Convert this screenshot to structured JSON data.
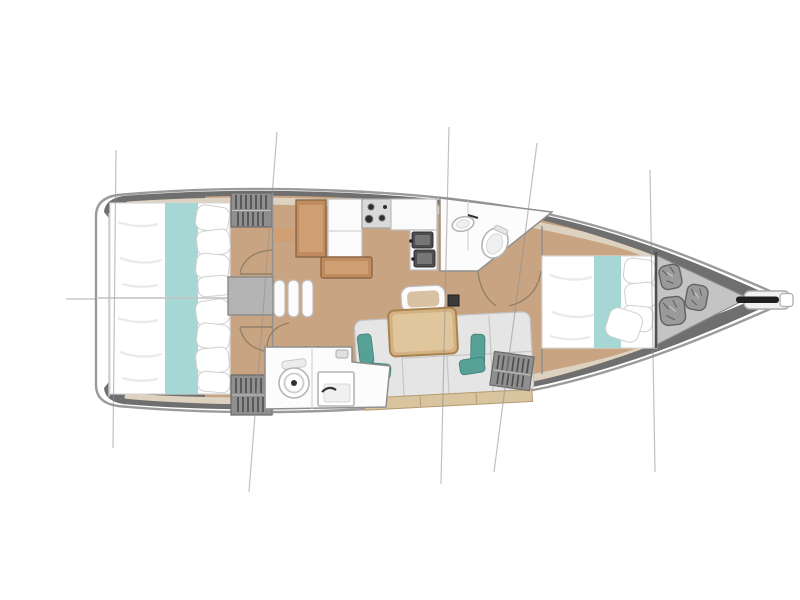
{
  "meta": {
    "diagram_type": "sailboat-interior-floor-plan",
    "view": "top-down",
    "orientation": "bow-right",
    "visible_text": []
  },
  "colors": {
    "background": "#ffffff",
    "hull_fill": "#ffffff",
    "hull_outline": "#9b9b9b",
    "deck_band": "#6f6f6f",
    "anchor_locker": "#c4c4c4",
    "floor_wood": "#c9a483",
    "furniture_wood": "#c08b5e",
    "furniture_wood_dark": "#8d6747",
    "furniture_wood_light": "#cf9f73",
    "trim_beige": "#ddd2c0",
    "bed_white": "#ffffff",
    "teal_runner": "#a7d7d5",
    "teal_pillow": "#57a096",
    "sofa_gray": "#e5e5e5",
    "sofa_stroke": "#c2c2c2",
    "locker_gray": "#8f8f8f",
    "locker_stripe": "#4c4c4c",
    "bathroom_white": "#fcfcfc",
    "wall_line": "#8f8f8f",
    "stainless": "#4e4e4e",
    "rig_line": "#8f8f8f",
    "door_arc": "#8f7f66",
    "mast_dark": "#3a3a3a",
    "anchor_roller": "#1f1f1f",
    "bag_gray": "#9a9a9a",
    "steps_gray": "#b4b4b4",
    "wood_base": "#d8c49e"
  },
  "components": [
    {
      "name": "hull",
      "desc": "sailboat hull outline, bow pointing right"
    },
    {
      "name": "rig-lines",
      "desc": "five thin rigging/shroud lines crossing the hull vertically"
    },
    {
      "name": "aft-cabin-port",
      "desc": "aft double berth with teal runner and pillows"
    },
    {
      "name": "aft-cabin-starboard",
      "desc": "aft double berth with teal runner and pillows"
    },
    {
      "name": "wardrobe-port",
      "desc": "hanging locker with clothes"
    },
    {
      "name": "wardrobe-starboard",
      "desc": "hanging locker with clothes"
    },
    {
      "name": "companionway-steps",
      "desc": "entry landing and three steps"
    },
    {
      "name": "galley",
      "desc": "stove with burners, cabinets, double sink, nav seat and table"
    },
    {
      "name": "forward-head",
      "desc": "bathroom with toilet and vanity sink"
    },
    {
      "name": "aft-head",
      "desc": "bathroom with toilet and sink"
    },
    {
      "name": "salon",
      "desc": "sofa with teal cushions, dining table, bench and mast base"
    },
    {
      "name": "forward-cabin",
      "desc": "forward double berth with teal runner and pillows"
    },
    {
      "name": "anchor-locker",
      "desc": "bow locker with three stowed bags"
    },
    {
      "name": "bowsprit",
      "desc": "bow platform with anchor roller"
    }
  ]
}
